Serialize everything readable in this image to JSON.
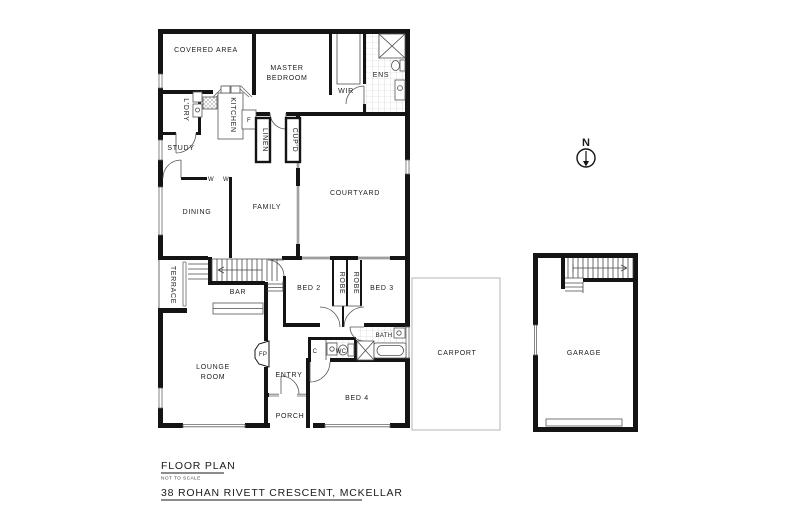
{
  "meta": {
    "title": "FLOOR PLAN",
    "scale_note": "NOT TO SCALE",
    "address": "38 ROHAN RIVETT CRESCENT, MCKELLAR"
  },
  "compass": {
    "north": "N"
  },
  "rooms": {
    "covered_area": "COVERED AREA",
    "master_bedroom_line1": "MASTER",
    "master_bedroom_line2": "BEDROOM",
    "wir": "WIR",
    "ens": "ENS",
    "ldry": "L'DRY",
    "kitchen": "KITCHEN",
    "fridge": "F",
    "study": "STUDY",
    "linen": "LINEN",
    "cupd": "CUP'D",
    "courtyard": "COURTYARD",
    "dining": "DINING",
    "family": "FAMILY",
    "w_marker_1": "W",
    "w_marker_2": "W",
    "terrace": "TERRACE",
    "bar": "BAR",
    "bed2": "BED 2",
    "robe_1": "ROBE",
    "robe_2": "ROBE",
    "bed3": "BED 3",
    "lounge_line1": "LOUNGE",
    "lounge_line2": "ROOM",
    "fireplace": "FP",
    "entry": "ENTRY",
    "porch": "PORCH",
    "bed4": "BED 4",
    "bath": "BATH",
    "wc": "WC",
    "cupboard": "C",
    "carport": "CARPORT",
    "garage": "GARAGE"
  },
  "colors": {
    "wall": "#141414",
    "thin_line": "#4a4a4a",
    "carport_outline": "#b5b5b5",
    "background": "#ffffff"
  }
}
